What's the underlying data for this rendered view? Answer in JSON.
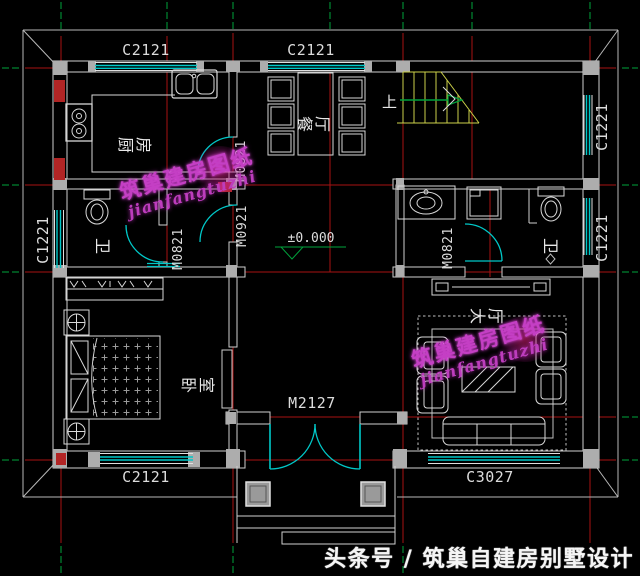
{
  "plan": {
    "windows": {
      "top_left": "C2121",
      "top_center": "C2121",
      "right_upper": "C1221",
      "right_lower": "C1221",
      "left": "C1221",
      "bottom_left": "C2121",
      "bottom_right": "C3027"
    },
    "doors": {
      "kitchen": "M0821",
      "lobby": "M0921",
      "bath_left": "M0821",
      "bath_right": "M0821",
      "entrance": "M2127"
    },
    "rooms": {
      "kitchen": "厨房",
      "dining": "餐厅",
      "bath_left": "卫",
      "bath_right": "卫",
      "bedroom": "卧室",
      "hall": "大厅"
    },
    "stairs_up_label": "上",
    "elevation_label": "±0.000"
  },
  "watermark": {
    "line1": "筑巢建房图纸",
    "line2": "jianfangtuzhi"
  },
  "footer": {
    "text": "头条号 / 筑巢自建房别墅设计"
  },
  "colors": {
    "background": "#000000",
    "axis_red": "#b01414",
    "centerline_green": "#00a33c",
    "opening_cyan": "#00c8c8",
    "stair_yellow": "#ccd14a",
    "wall_gray": "#cfcfcf",
    "pier_gray": "#adadad",
    "pier_red": "#b22525",
    "watermark_magenta": "#c43fc4",
    "text_white": "#e8e8e8"
  }
}
